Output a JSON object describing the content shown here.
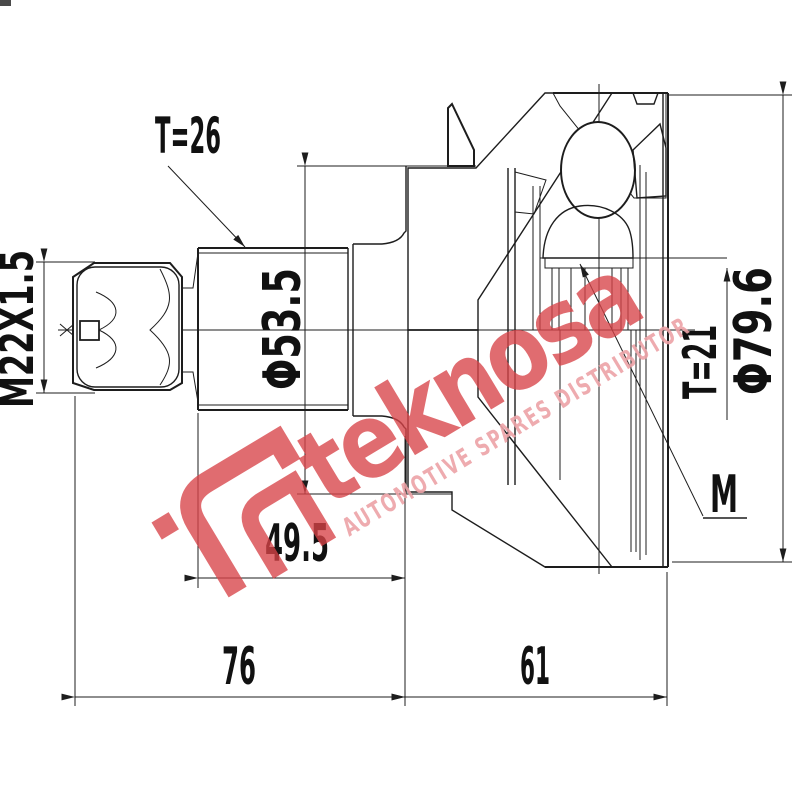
{
  "title": "CV joint technical drawing",
  "drawing": {
    "dimensions": {
      "thread": "M22X1.5",
      "outer_spline_teeth": "T=26",
      "boot_diameter": "Φ53.5",
      "inner_spline_teeth": "T=21",
      "outer_diameter": "Φ79.6",
      "module_label": "M",
      "boot_length": "49.5",
      "shaft_length": "76",
      "joint_length": "61"
    },
    "colors": {
      "line": "#1d1d1d",
      "background": "#ffffff"
    }
  },
  "watermark": {
    "brand": "teknosa",
    "tagline": "AUTOMOTIVE SPARES DISTRIBUTOR",
    "brand_color": "#d84348",
    "tagline_color": "#eda3a7"
  }
}
